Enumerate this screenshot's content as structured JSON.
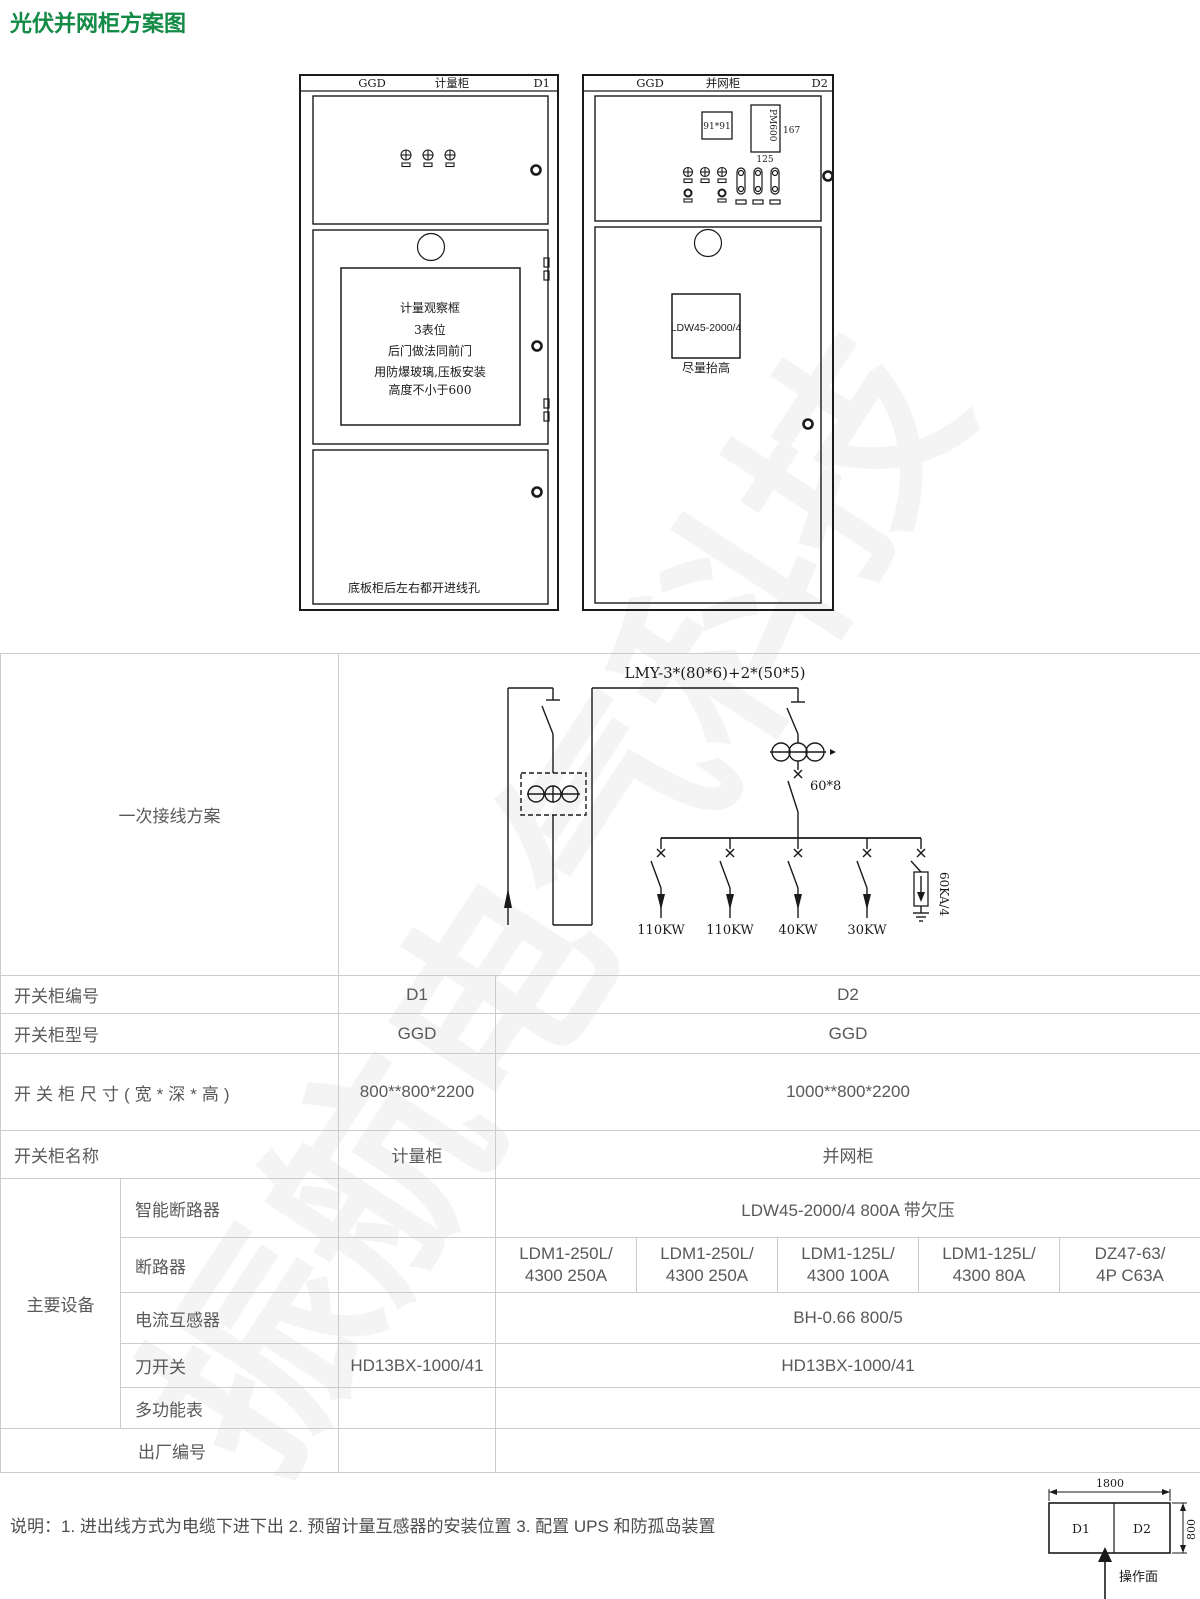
{
  "page": {
    "title": "光伏并网柜方案图",
    "note": "说明：1. 进出线方式为电缆下进下出 2. 预留计量互感器的安装位置 3. 配置 UPS 和防孤岛装置",
    "watermark": "振航电气科技"
  },
  "colors": {
    "title_green": "#138a45",
    "table_text": "#595959",
    "table_border": "#cccccc",
    "drawing_line": "#1a1a1a"
  },
  "cabinets": {
    "left": {
      "model": "GGD",
      "name": "计量柜",
      "code": "D1",
      "window_note": [
        "计量观察框",
        "3表位",
        "后门做法同前门",
        "用防爆玻璃,压板安装",
        "高度不小于600"
      ],
      "bottom_note": "底板柜后左右都开进线孔"
    },
    "right": {
      "model": "GGD",
      "name": "并网柜",
      "code": "D2",
      "meter_box": "91*91",
      "multimeter_box": "PM600",
      "dim_167": "167",
      "dim_125": "125",
      "breaker_box": "LDW45-2000/4",
      "breaker_note": "尽量抬高"
    }
  },
  "wiring": {
    "title": "一次接线方案",
    "bus_label": "LMY-3*(80*6)+2*(50*5)",
    "busbar_size": "60*8",
    "arrester": "60KA/4",
    "loads": [
      "110KW",
      "110KW",
      "40KW",
      "30KW"
    ]
  },
  "table": {
    "code": {
      "label": "开关柜编号",
      "d1": "D1",
      "d2": "D2"
    },
    "model": {
      "label": "开关柜型号",
      "d1": "GGD",
      "d2": "GGD"
    },
    "size": {
      "label": "开关柜尺寸(宽*深*高)",
      "d1": "800**800*2200",
      "d2": "1000**800*2200"
    },
    "name": {
      "label": "开关柜名称",
      "d1": "计量柜",
      "d2": "并网柜"
    },
    "equipment_label": "主要设备",
    "smart_breaker": {
      "label": "智能断路器",
      "d1": "",
      "d2": "LDW45-2000/4 800A 带欠压"
    },
    "breaker": {
      "label": "断路器",
      "d1": "",
      "values": [
        "LDM1-250L/\n4300 250A",
        "LDM1-250L/\n4300 250A",
        "LDM1-125L/\n4300 100A",
        "LDM1-125L/\n4300 80A",
        "DZ47-63/\n4P C63A"
      ]
    },
    "ct": {
      "label": "电流互感器",
      "d1": "",
      "d2": "BH-0.66 800/5"
    },
    "knife_switch": {
      "label": "刀开关",
      "d1": "HD13BX-1000/41",
      "d2": "HD13BX-1000/41"
    },
    "multimeter": {
      "label": "多功能表",
      "d1": "",
      "d2": ""
    },
    "serial": {
      "label": "出厂编号",
      "d1": "",
      "d2": ""
    }
  },
  "layout_plan": {
    "width": "1800",
    "depth": "800",
    "cell1": "D1",
    "cell2": "D2",
    "face": "操作面"
  }
}
